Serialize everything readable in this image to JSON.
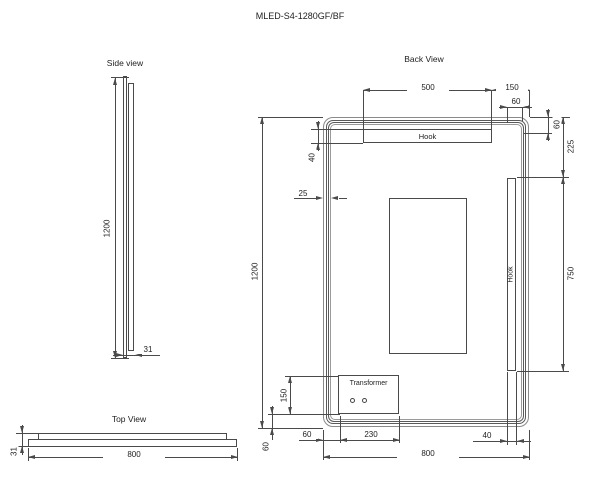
{
  "title": "MLED-S4-1280GF/BF",
  "side_view": {
    "label": "Side view",
    "height": "1200",
    "thickness": "31"
  },
  "top_view": {
    "label": "Top View",
    "width": "800",
    "thickness": "31"
  },
  "back_view": {
    "label": "Back View",
    "hook_top_label": "Hook",
    "hook_side_label": "Hook",
    "transformer_label": "Transformer",
    "dims": {
      "hook_width": "500",
      "hook_to_right_edge": "150",
      "hook_gap_top": "60",
      "edge_to_hook_bottom": "60",
      "top_to_side_hook": "225",
      "side_hook_length": "750",
      "hook_height": "40",
      "frame_inset": "25",
      "overall_height": "1200",
      "transformer_height": "150",
      "transformer_offset_left": "60",
      "transformer_width": "230",
      "transformer_offset_bottom": "60",
      "overall_width": "800",
      "side_hook_inset": "40"
    }
  }
}
